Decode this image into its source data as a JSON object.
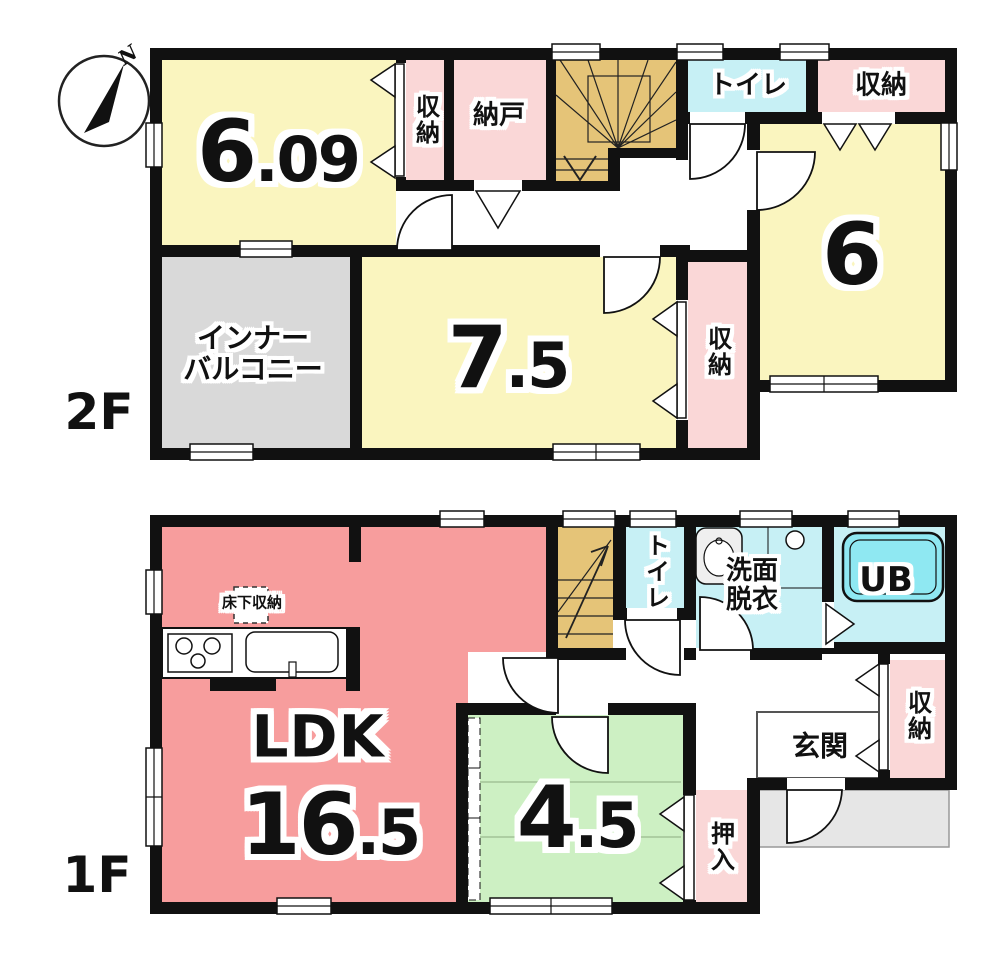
{
  "compass": {
    "north_label": "N"
  },
  "colors": {
    "room_yellow": "#faf5bf",
    "storage_pink": "#fad7d7",
    "ldk_salmon": "#f79d9d",
    "tatami_green": "#cdf0c3",
    "wet_cyan": "#c7f0f5",
    "tub_cyan": "#8fe8f2",
    "stairs_tan": "#e5c478",
    "balcony_gray": "#d9d9d9",
    "porch_gray": "#e6e6e6",
    "wall_black": "#111111"
  },
  "floor_2f": {
    "floor_label": "2F",
    "room_609": {
      "area_main": "6",
      "area_frac": ".09"
    },
    "closet_west": "収納",
    "storeroom": "納戸",
    "toilet": "トイレ",
    "closet_northeast": "収納",
    "room_6": {
      "area_main": "6"
    },
    "closet_center": "収納",
    "room_75": {
      "area_main": "7",
      "area_frac": ".5"
    },
    "inner_balcony_line1": "インナー",
    "inner_balcony_line2": "バルコニー"
  },
  "floor_1f": {
    "floor_label": "1F",
    "ldk": {
      "name": "LDK",
      "area_main": "16",
      "area_frac": ".5"
    },
    "underfloor_storage": "床下収納",
    "toilet": "トイレ",
    "washroom_line1": "洗面",
    "washroom_line2": "脱衣",
    "unit_bath": "UB",
    "entrance": "玄関",
    "closet_east": "収納",
    "oshiire": "押入",
    "room_45": {
      "area_main": "4",
      "area_frac": ".5"
    }
  }
}
